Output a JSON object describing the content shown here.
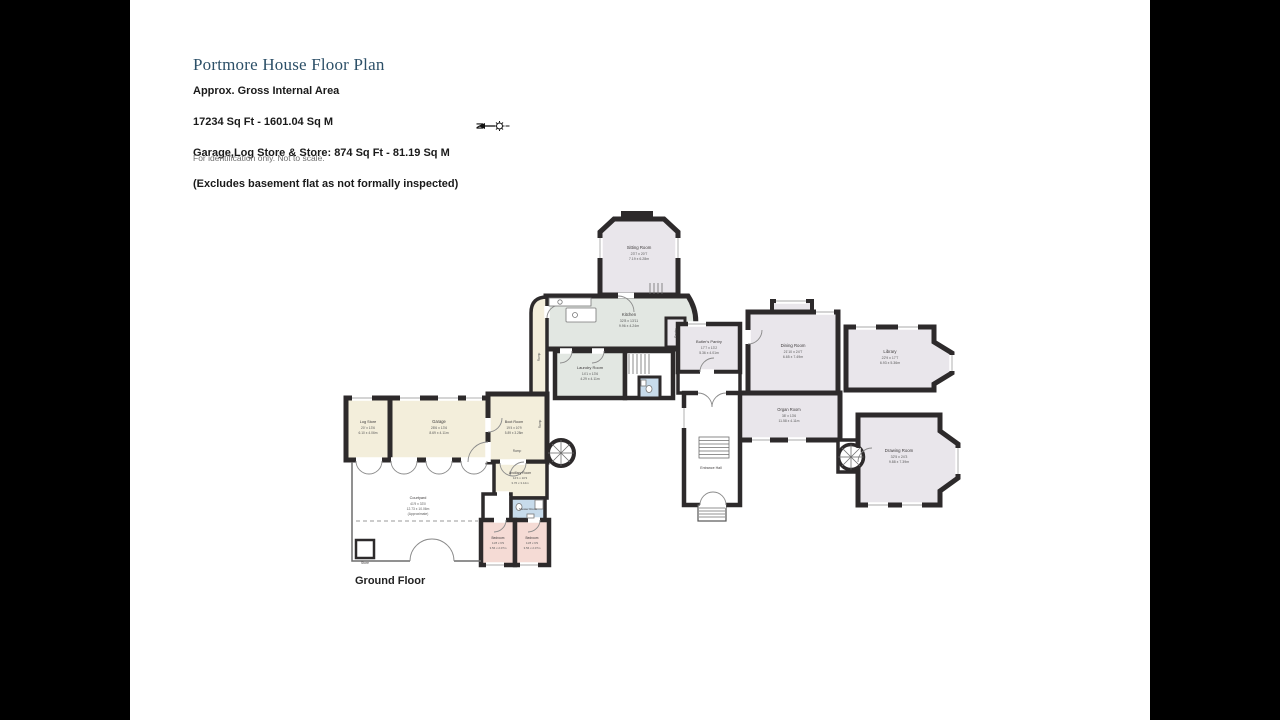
{
  "header": {
    "title": "Portmore House Floor Plan",
    "line1": "Approx. Gross Internal Area",
    "line2": "17234 Sq Ft - 1601.04 Sq M",
    "line3": "Garage,Log Store & Store: 874 Sq Ft - 81.19 Sq M",
    "line4": "(Excludes basement flat as not formally inspected)",
    "disclaimer": "For identification only. Not to scale.",
    "compass_letter": "N"
  },
  "floor_label": "Ground Floor",
  "colors": {
    "wall": "#2d2a2b",
    "room_grey": "#e9e6eb",
    "room_green": "#e2e7e2",
    "room_cream": "#f3eedb",
    "room_pink": "#f5dbd5",
    "room_blue": "#c7dbeb",
    "title_blue": "#2d5068"
  },
  "rooms": {
    "sitting": {
      "label": "Sitting Room",
      "dims_ft": "23'7 x 20'7",
      "dims_m": "7.19 x 6.28m"
    },
    "kitchen": {
      "label": "Kitchen",
      "dims_ft": "32'8 x 13'11",
      "dims_m": "9.96 x 4.24m"
    },
    "laundry": {
      "label": "Laundry Room",
      "dims_ft": "14'1 x 13'6",
      "dims_m": "4.29 x 4.11m"
    },
    "pantry": {
      "label": "Pantry"
    },
    "butlers_pantry": {
      "label": "Butler's Pantry",
      "dims_ft": "17'7 x 13'2",
      "dims_m": "5.36 x 4.01m"
    },
    "dining": {
      "label": "Dining Room",
      "dims_ft": "21'10 x 24'7",
      "dims_m": "6.65 x 7.49m"
    },
    "library": {
      "label": "Library",
      "dims_ft": "22'9 x 17'7",
      "dims_m": "6.93 x 5.36m"
    },
    "organ": {
      "label": "Organ Room",
      "dims_ft": "38' x 13'6",
      "dims_m": "11.58 x 4.11m"
    },
    "drawing": {
      "label": "Drawing Room",
      "dims_ft": "32'5 x 24'3",
      "dims_m": "9.88 x 7.39m"
    },
    "entrance": {
      "label": "Entrance Hall"
    },
    "log_store": {
      "label": "Log Store",
      "dims_ft": "20' x 13'6",
      "dims_m": "6.10 x 4.06m"
    },
    "garage": {
      "label": "Garage",
      "dims_ft": "28'6 x 13'6",
      "dims_m": "8.69 x 4.11m"
    },
    "boot_room": {
      "label": "Boot Room",
      "dims_ft": "19'4 x 10'9",
      "dims_m": "5.89 x 3.28m"
    },
    "ancillary": {
      "label": "Ancillary Room",
      "dims_ft": "12'4 x 10'3",
      "dims_m": "3.76 x 3.12m"
    },
    "shower": {
      "label": "Shower Room"
    },
    "bedroom1": {
      "label": "Bedroom",
      "dims_ft": "11'8 x 6'9",
      "dims_m": "3.56 x 2.07m"
    },
    "bedroom2": {
      "label": "Bedroom",
      "dims_ft": "11'8 x 6'9",
      "dims_m": "3.56 x 2.07m"
    },
    "courtyard": {
      "label": "Courtyard",
      "dims_ft": "41'9 x 33'0",
      "dims_m": "12.73 x 10.06m",
      "note": "(Approximate)"
    },
    "store": {
      "label": "Store"
    },
    "ramp": {
      "label": "Ramp"
    }
  }
}
